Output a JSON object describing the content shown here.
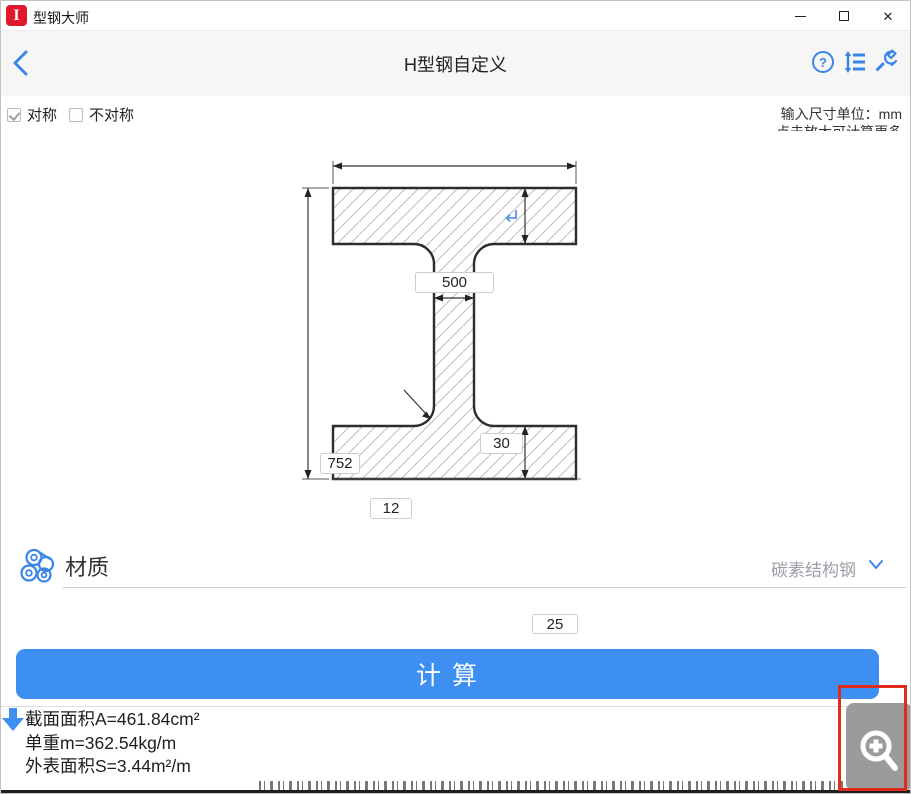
{
  "titlebar": {
    "app_title": "型钢大师"
  },
  "header": {
    "title": "H型钢自定义"
  },
  "options": {
    "symmetric_label": "对称",
    "asymmetric_label": "不对称",
    "unit_hint": "输入尺寸单位：mm",
    "more_hint": "点击放大可计算更多"
  },
  "drawing": {
    "width_top": "500",
    "height": "752",
    "web_thickness": "30",
    "fillet_radius": "12",
    "flange_thickness": "25"
  },
  "material": {
    "section_label": "材质",
    "selected": "碳素结构钢"
  },
  "calculate_label": "计 算",
  "results": {
    "area": "截面面积A=461.84cm²",
    "weight": "单重m=362.54kg/m",
    "surface": "外表面积S=3.44m²/m"
  },
  "colors": {
    "accent_blue": "#3a86e8",
    "button_blue": "#3d8ff2",
    "brand_red": "#e2182c",
    "annotation_red": "#e02b1e",
    "magnifier_gray": "#9b9b9b"
  }
}
